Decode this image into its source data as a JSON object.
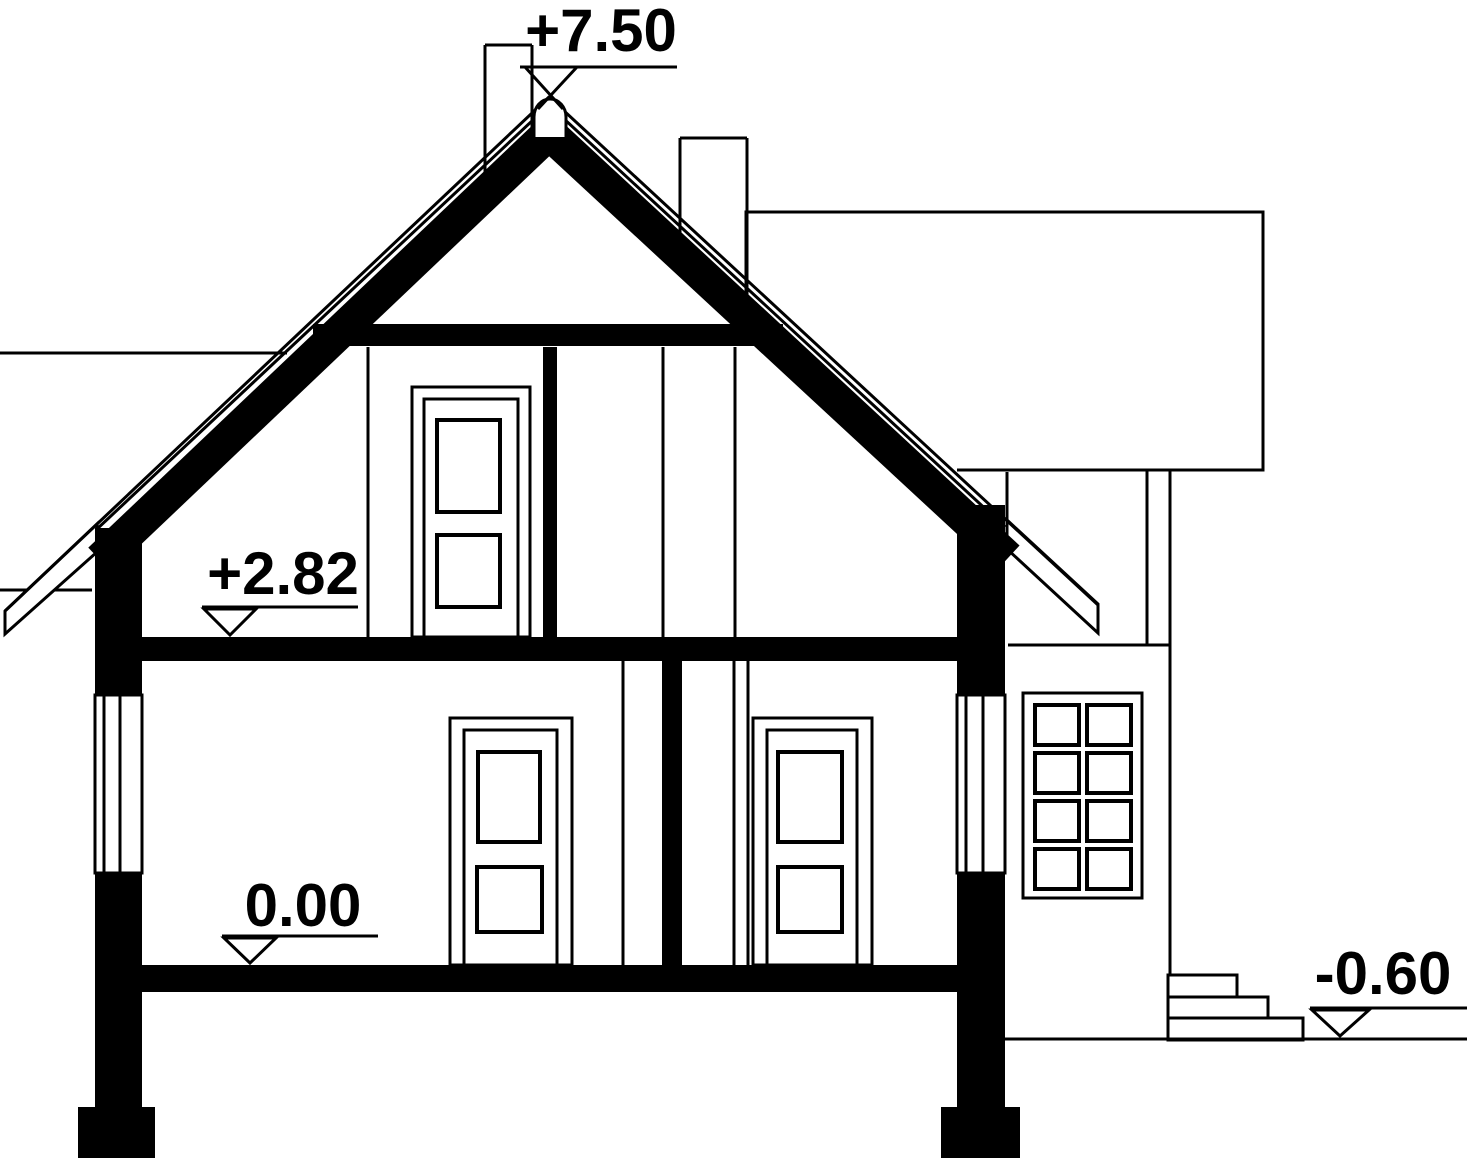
{
  "drawing": {
    "paper_color": "#ffffff",
    "line_color": "#000000",
    "markers": {
      "ridge": {
        "label": "+7.50"
      },
      "attic_floor": {
        "label": "+2.82"
      },
      "ground_floor": {
        "label": "0.00"
      },
      "terrain": {
        "label": "-0.60"
      }
    }
  }
}
